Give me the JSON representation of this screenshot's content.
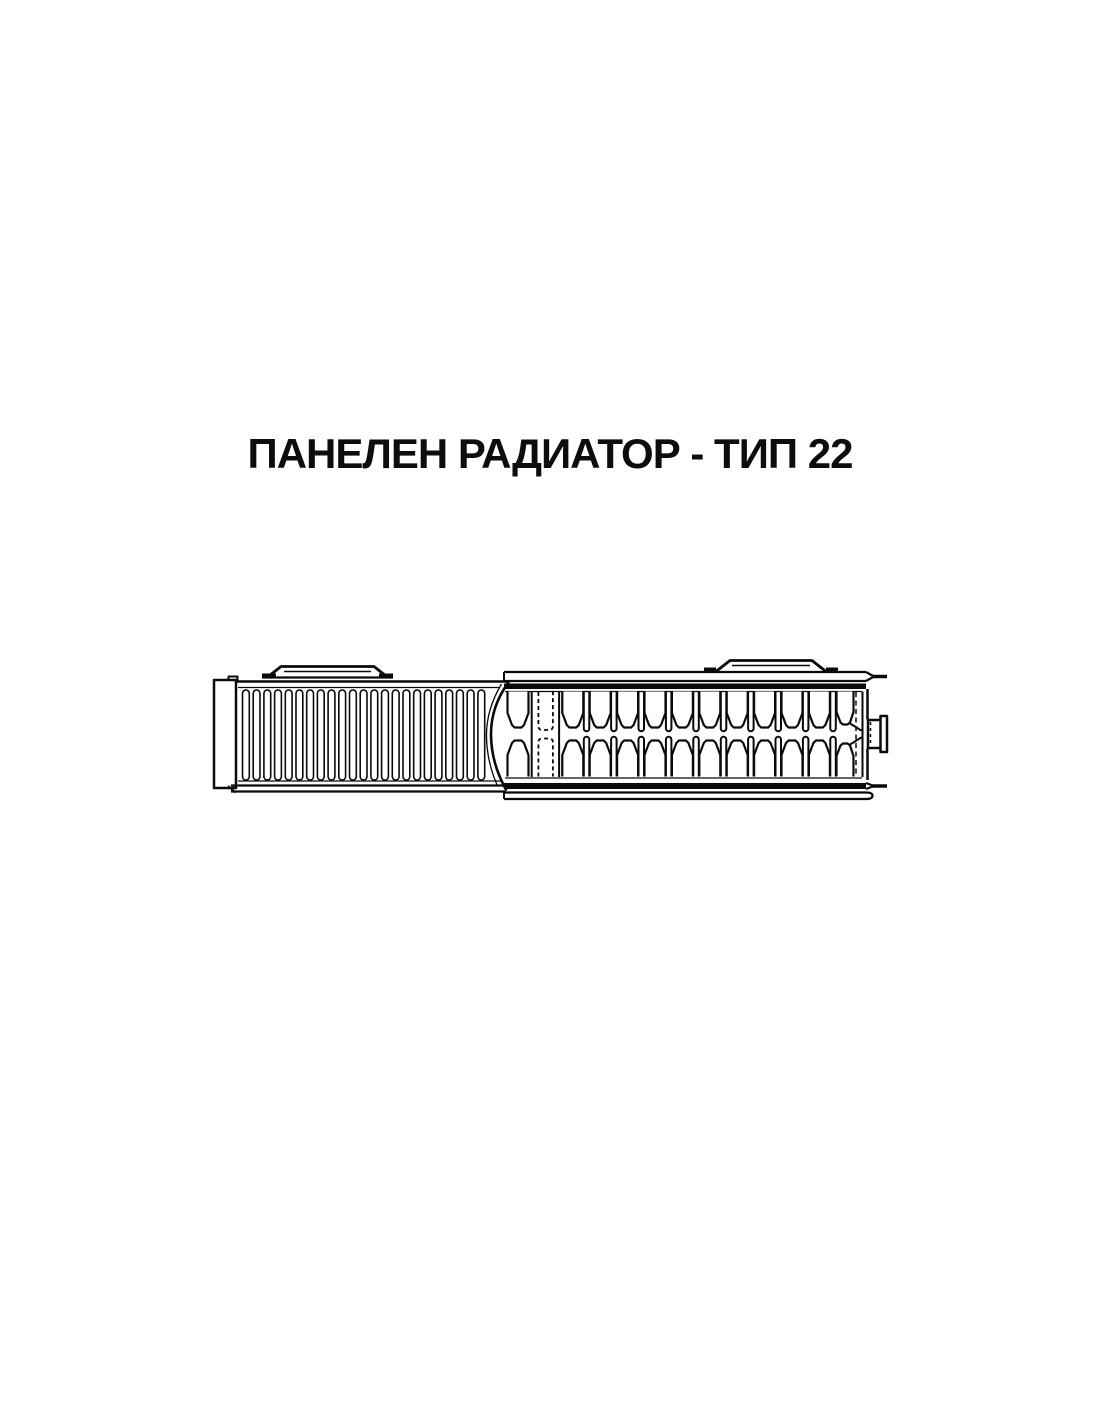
{
  "page": {
    "background": "#ffffff",
    "ink": "#0a0a0a"
  },
  "title": {
    "text": "ПАНЕЛЕН РАДИАТОР - ТИП 22"
  },
  "diagram": {
    "description": "panel-radiator-type-22-horizontal-cross-section",
    "front_grille": {
      "slot_count": 23
    },
    "convector": {
      "period_count": 12,
      "dashed_period_index": 1
    }
  }
}
